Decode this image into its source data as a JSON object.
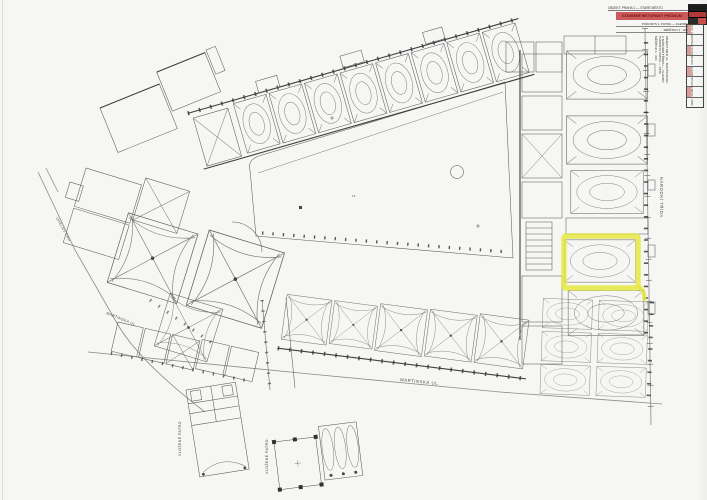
{
  "document": {
    "type": "scanned architectural floor plan with highlighted room",
    "highlight_color": "#e4e63a",
    "stamp_red": "#cd5a5a",
    "ink": "#3f3f3f",
    "background": "#f6f6f4"
  },
  "streets": {
    "right_vertical": "NÁRODNÍ TŘÍDA",
    "bottom": "MARTINSKÁ UL.",
    "left": "MARTINSKÁ UL.",
    "upper_left_diagonal": "UHELNÝ TRH"
  },
  "notes": {
    "inset_floor_1": "VLOŽENÉ PATRO",
    "inset_floor_2": "VLOŽENÉ PATRO",
    "courtyard_mark": "13"
  },
  "title_block": {
    "top_line": "OBJEKT: PRAHA 1 — STARÉ MĚSTO",
    "red_bar": "STAVEBNĚ HISTORICKÝ PRŮZKUM",
    "sub_line_1": "PŮDORYS 1. PATRA — KLENBY",
    "sub_line_2": "MĚŘÍTKO 1 : 200",
    "side_notes": [
      "OBJEKT MEZI UL. MARTINSKOU",
      "A NÁRODNÍ TŘÍDOU — KLENBY",
      "PŮDORYS PATRA — STAV",
      "MĚŘÍTKO 1 : 200"
    ],
    "table_rows": [
      "VED. ÚKOLU",
      "VYPRACOVAL",
      "KRESLIL",
      "DATUM",
      "MĚŘÍTKO",
      "Č. VÝKRESU",
      "FORMÁT",
      "PARÉ"
    ]
  }
}
